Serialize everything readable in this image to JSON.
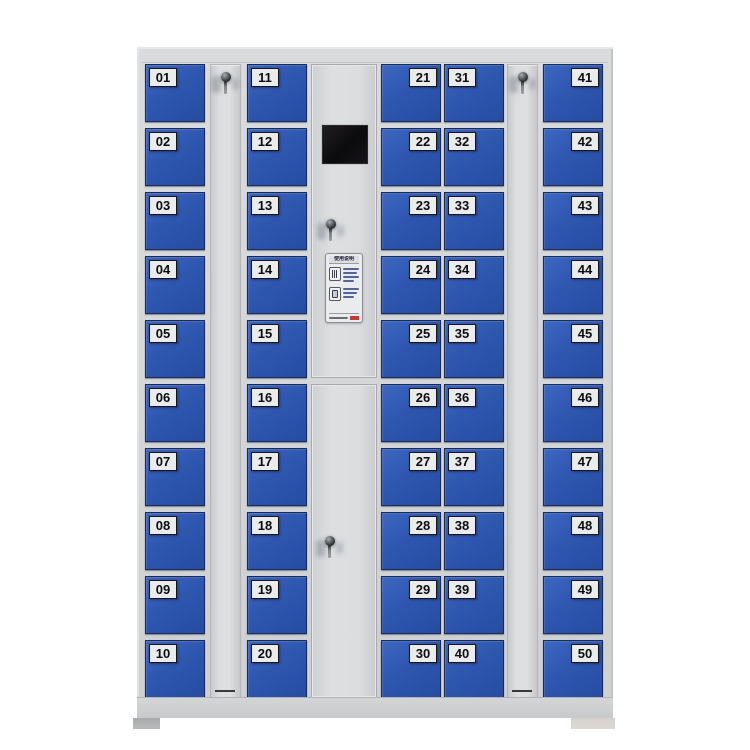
{
  "cabinet": {
    "description": "50-door smart storage locker cabinet, blue doors on light gray steel frame",
    "door_count": 50,
    "columns": [
      {
        "type": "doors",
        "id": "col-1",
        "plate_side": "left",
        "doors": [
          "01",
          "02",
          "03",
          "04",
          "05",
          "06",
          "07",
          "08",
          "09",
          "10"
        ]
      },
      {
        "type": "panel",
        "id": "side-panel-left",
        "has_lock": true
      },
      {
        "type": "doors",
        "id": "col-2",
        "plate_side": "left",
        "doors": [
          "11",
          "12",
          "13",
          "14",
          "15",
          "16",
          "17",
          "18",
          "19",
          "20"
        ]
      },
      {
        "type": "control",
        "id": "control-column",
        "has_screen": true,
        "lock_count": 2
      },
      {
        "type": "doors",
        "id": "col-3",
        "plate_side": "right",
        "doors": [
          "21",
          "22",
          "23",
          "24",
          "25",
          "26",
          "27",
          "28",
          "29",
          "30"
        ]
      },
      {
        "type": "doors",
        "id": "col-4",
        "plate_side": "left",
        "doors": [
          "31",
          "32",
          "33",
          "34",
          "35",
          "36",
          "37",
          "38",
          "39",
          "40"
        ]
      },
      {
        "type": "panel",
        "id": "side-panel-right",
        "has_lock": true
      },
      {
        "type": "doors",
        "id": "col-5",
        "plate_side": "right",
        "doors": [
          "41",
          "42",
          "43",
          "44",
          "45",
          "46",
          "47",
          "48",
          "49",
          "50"
        ]
      }
    ],
    "control_panel": {
      "label_title": "使用说明"
    },
    "colors": {
      "door_blue": "#2e57b0",
      "door_blue_light": "#3c67c1",
      "frame_gray": "#d3d5d7",
      "plate_bg": "#e9ebed",
      "plate_text": "#0d0d0f",
      "screen_black": "#0b0a0c",
      "accent_red": "#c4392e"
    }
  }
}
